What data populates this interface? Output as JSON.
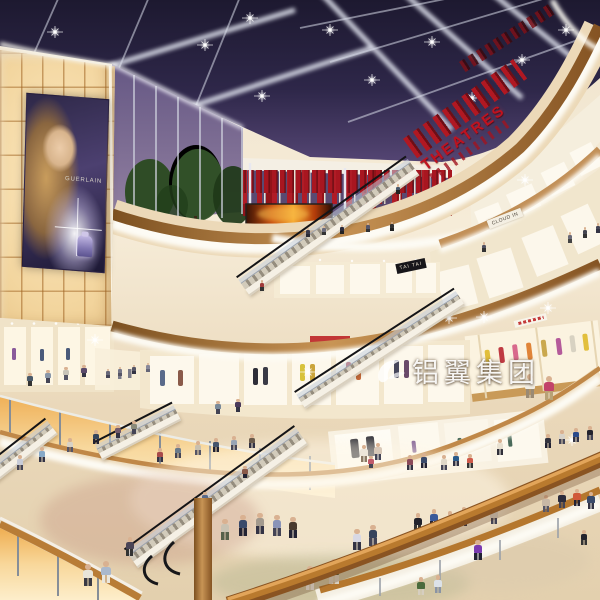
{
  "scene": {
    "title": "Shopping mall atrium interior — evening architectural rendering",
    "setting": "Multi-level retail atrium with dark skylight grid, curved balconies, escalators and crowds"
  },
  "signs": {
    "theatres": "THEATRES",
    "cloud_in": "CLOUD IN",
    "tai_tai": "TAI TAI",
    "billboard_brand": "GUERLAIN"
  },
  "watermark": {
    "logo": "swoosh-bird-icon",
    "text": "铝翼集团"
  },
  "palette": {
    "skylight": "#292344",
    "beam_white": "#e6e8f2",
    "theatre_red": "#b01822",
    "wood": "#b5782f",
    "fascia_white": "#f7f3ea",
    "wall_glow": "#f6dcae",
    "floor_beige": "#e6d3b4",
    "amber_glass": "#f3c87e"
  }
}
